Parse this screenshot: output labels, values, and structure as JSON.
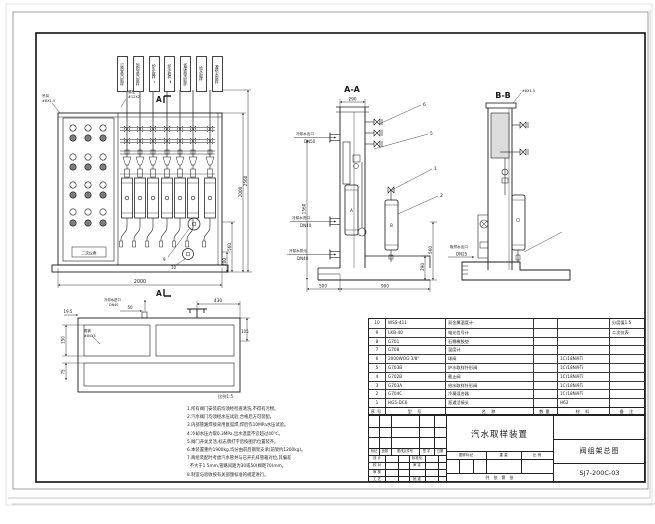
{
  "drawing": {
    "title": "汽水取样装置",
    "subtitle": "阀组架总图",
    "number": "SJ7-200C-03"
  },
  "views": {
    "main": {
      "section_mark": "A",
      "tags": [
        "过热蒸汽取样",
        "饱和蒸汽取样",
        "炉水取样Ⅰ",
        "炉水取样Ⅱ",
        "省煤器水取样",
        "给水取样",
        "凝结水取样"
      ],
      "panel_label": "二次仪表",
      "labels": {
        "lifting": "吊耳",
        "lifting_spec": "#8X1.5",
        "bolt": "螺栓",
        "bolt_spec": "#12X2"
      },
      "dims": {
        "width": "2000",
        "height_1": "2000",
        "height_2": "2560",
        "d560": "560",
        "d200": "200"
      },
      "callouts": [
        "9",
        "10"
      ]
    },
    "plan": {
      "dims": {
        "d195": "19.5",
        "d50": "50",
        "d430": "430",
        "d105": "105",
        "d150": "150",
        "d75": "75"
      },
      "labels": {
        "angle": "角钢",
        "angle_spec": "#80X5",
        "inlet": "冷却水进口",
        "inlet_spec": "DN40"
      },
      "note_right": "比例1:5"
    },
    "aa": {
      "title": "A-A",
      "dims": {
        "d290": "290",
        "d1560": "1560",
        "d500": "500",
        "d900": "900",
        "d560": "560",
        "d290b": "290"
      },
      "ports": [
        {
          "name": "冷却水出口",
          "dn": "DN50"
        },
        {
          "name": "冷却水进口",
          "dn": "DN40"
        },
        {
          "name": "冷却水排污",
          "dn": "DN40"
        }
      ],
      "vessel_a": "A",
      "vessel_b": "B",
      "callouts": [
        "6",
        "5",
        "1",
        "2"
      ]
    },
    "bb": {
      "title": "B-B",
      "label": "#8X1.5",
      "port": {
        "name": "取样水出口",
        "dn": "DN25"
      }
    }
  },
  "notes": {
    "lines": [
      "1.所有阀门安装前均须经检查清洗,不得有污物。",
      "2.汽水阀门均须经水压试验,合格后方可装配。",
      "3.内部管路焊接采用氩弧焊,焊后作10MPa水压试验。",
      "4.冷却水压力取0.3MPa,出水温度不宜超过40℃。",
      "5.阀门开关灵活,标志牌打字后按图示位置装齐。",
      "6.本装置重约1900kg,均分由前后钢架支承(前架约1200kg)。",
      "7.两组装配时考虑汽水管并与已开孔排管箱对位,其偏差",
      "  不大于1.5mm,管路间距为30或50(阀距70)mm。",
      "8.制造与验收按有关部颁标准的规定进行。"
    ]
  },
  "parts_table": {
    "headers": [
      "序号",
      "型 号",
      "名 称",
      "数量",
      "材 料",
      "备 注"
    ],
    "rows": [
      [
        "10",
        "WSS-411",
        "双金属温度计",
        "",
        "",
        "分度值1.5"
      ],
      [
        "9",
        "LKB-40",
        "电光信号计",
        "",
        "",
        "二次仪表"
      ],
      [
        "8",
        "G701",
        "石棉橡胶垫",
        "",
        "",
        ""
      ],
      [
        "7",
        "G708",
        "温度计",
        "",
        "",
        ""
      ],
      [
        "6",
        "2000WOG 3/8\"",
        "球阀",
        "",
        "1Cr18Ni9Ti",
        ""
      ],
      [
        "5",
        "G703B",
        "炉水取样针形阀",
        "",
        "1Cr18Ni9Ti",
        ""
      ],
      [
        "4",
        "G702B",
        "截止阀",
        "",
        "1Cr18Ni9Ti",
        ""
      ],
      [
        "3",
        "G703A",
        "给水取样针形阀",
        "",
        "1Cr18Ni9Ti",
        ""
      ],
      [
        "2",
        "G704C",
        "冷凝混合器",
        "",
        "1Cr18Ni9Ti",
        ""
      ],
      [
        "1",
        "HG5-DC6",
        "直通活接头",
        "",
        "H62",
        ""
      ]
    ]
  },
  "title_block": {
    "rev_header": [
      "标记",
      "处数",
      "更改文件号",
      "签 字",
      "日期"
    ],
    "sign_rows": [
      [
        "设 计",
        "标准化"
      ],
      [
        "校 对",
        "审 定"
      ],
      [
        "审 核",
        ""
      ],
      [
        "工 艺",
        "批 准"
      ]
    ],
    "stamp_headers": [
      "图样标记",
      "重 量",
      "比 例"
    ],
    "sheet_row": "共　张　第　张",
    "title": "汽水取样装置",
    "subtitle": "阀组架总图",
    "number": "SJ7-200C-03"
  }
}
